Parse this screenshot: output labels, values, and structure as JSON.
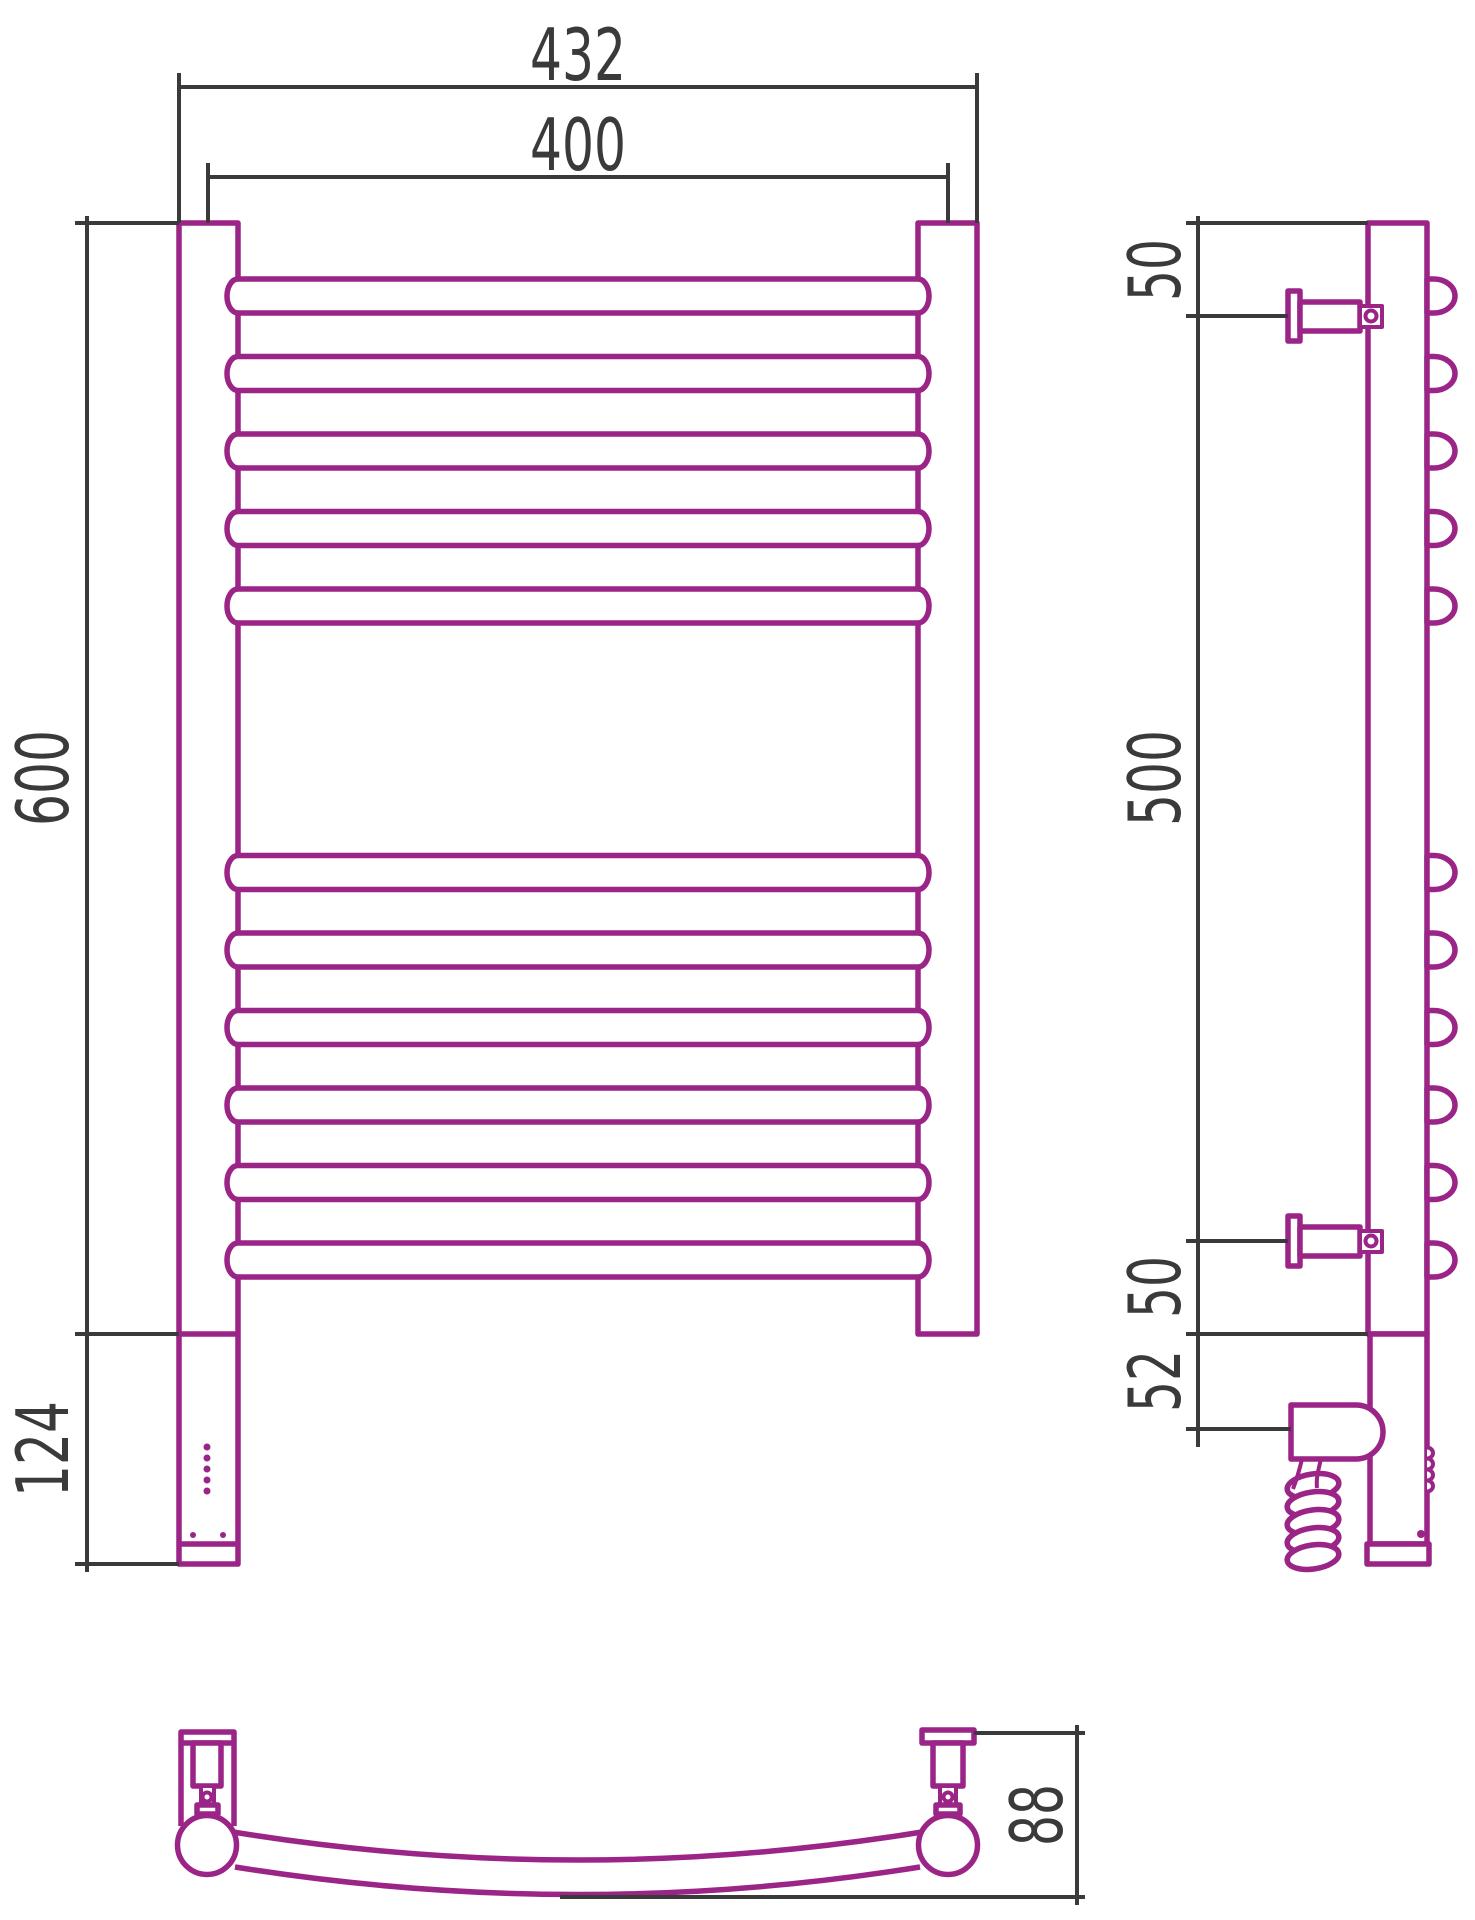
{
  "drawing": {
    "title": "heated-towel-rail-technical-drawing",
    "colors": {
      "product": "#9B2487",
      "lines": "#3a3a3a",
      "background": "#ffffff"
    },
    "dims": {
      "front": {
        "overall_width": "432",
        "center_width": "400",
        "rail_height": "600",
        "housing_height": "124"
      },
      "side": {
        "top_to_bracket": "50",
        "bracket_span": "500",
        "bracket_to_bottom": "50",
        "bottom_to_heater": "52"
      },
      "top": {
        "wall_depth": "88"
      }
    },
    "rails": {
      "top_group_count": 5,
      "bottom_group_count": 6
    },
    "indicators": {
      "front_led_count": 5,
      "side_led_count": 4
    }
  }
}
